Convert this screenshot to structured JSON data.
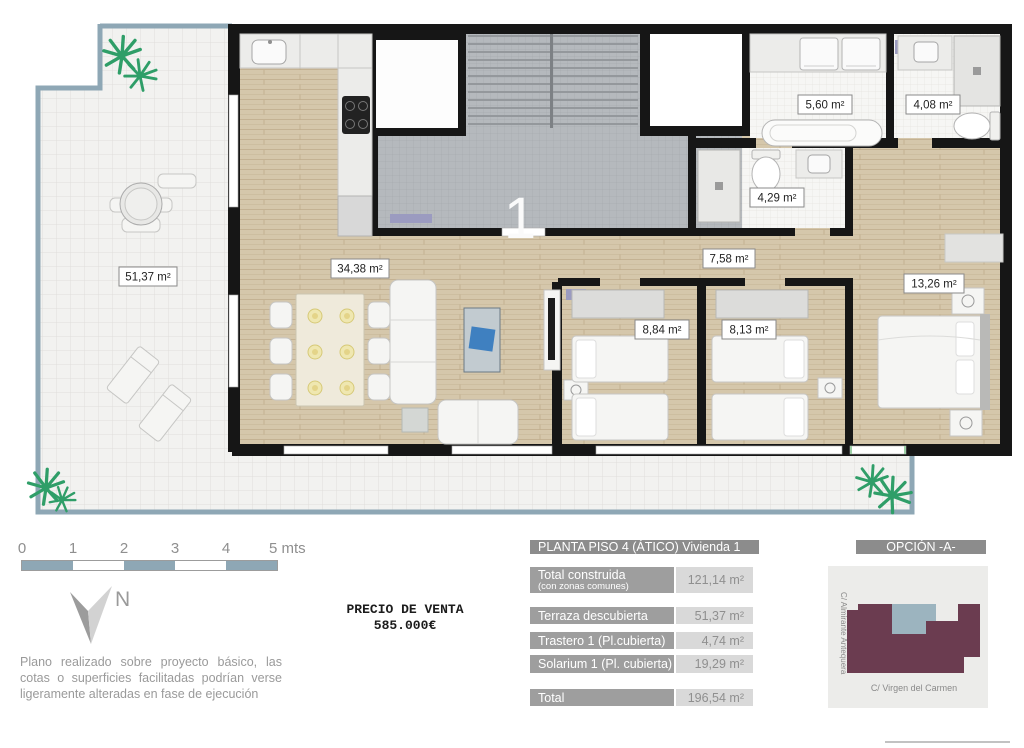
{
  "plan": {
    "unit_label": "1",
    "room_labels": {
      "terraza": "51,37 m²",
      "salon": "34,38 m²",
      "pasillo": "7,58 m²",
      "dormitorio_1": "8,84 m²",
      "dormitorio_2": "8,13 m²",
      "dormitorio_principal": "13,26 m²",
      "lavadero": "5,60 m²",
      "bano_1": "4,08 m²",
      "bano_2": "4,29 m²"
    },
    "colors": {
      "wall": "#161616",
      "terrace_edge": "#8ea7b5",
      "wood_floor": "#d5c7ab",
      "communal_tile": "#b5b9bd",
      "plant_green": "#2f9e68"
    }
  },
  "scale_bar": {
    "labels": [
      "0",
      "1",
      "2",
      "3",
      "4",
      "5 mts"
    ],
    "segment_color": "#8ea7b5"
  },
  "compass": {
    "label": "N"
  },
  "price": {
    "line1": "PRECIO DE VENTA",
    "line2": "585.000€"
  },
  "disclaimer": "Plano realizado sobre proyecto básico, las cotas o superficies facilitadas podrían verse ligeramente alteradas en fase de ejecución",
  "summary_table": {
    "title": "PLANTA PISO 4 (ÁTICO) Vivienda 1",
    "option": "OPCIÓN -A-",
    "rows": [
      {
        "label": "Total construida",
        "sublabel": "(con zonas comunes)",
        "value": "121,14 m²"
      },
      {
        "label": "Terraza descubierta",
        "sublabel": "",
        "value": "51,37 m²"
      },
      {
        "label": "Trastero 1 (Pl.cubierta)",
        "sublabel": "",
        "value": "4,74 m²"
      },
      {
        "label": "Solarium 1 (Pl. cubierta)",
        "sublabel": "",
        "value": "19,29 m²"
      }
    ],
    "total": {
      "label": "Total",
      "value": "196,54 m²"
    }
  },
  "location_map": {
    "street_vertical": "C/ Almirante Antequera",
    "street_horizontal": "C/ Virgen del Carmen",
    "building_color": "#6b3c50",
    "unit_color": "#9cb4bf",
    "background": "#ececea"
  }
}
